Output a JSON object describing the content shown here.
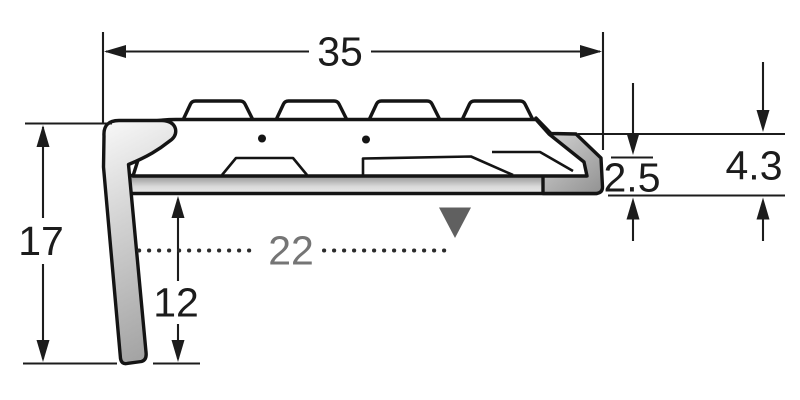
{
  "diagram": {
    "labels": {
      "top_width": "35",
      "overall_height": "17",
      "base_length": "22",
      "leg_height": "12",
      "edge_step": "2.5",
      "front_height": "4.3"
    },
    "colors": {
      "background": "#ffffff",
      "outline": "#141414",
      "dimension_line": "#1c1c1c",
      "muted_gray": "#757575",
      "muted_dots": "#2b2b2b",
      "marker_gray": "#606060",
      "metal_light": "#fbfbfb",
      "metal_dark": "#a4a4a4"
    },
    "marker": {
      "shape": "down-triangle"
    }
  }
}
